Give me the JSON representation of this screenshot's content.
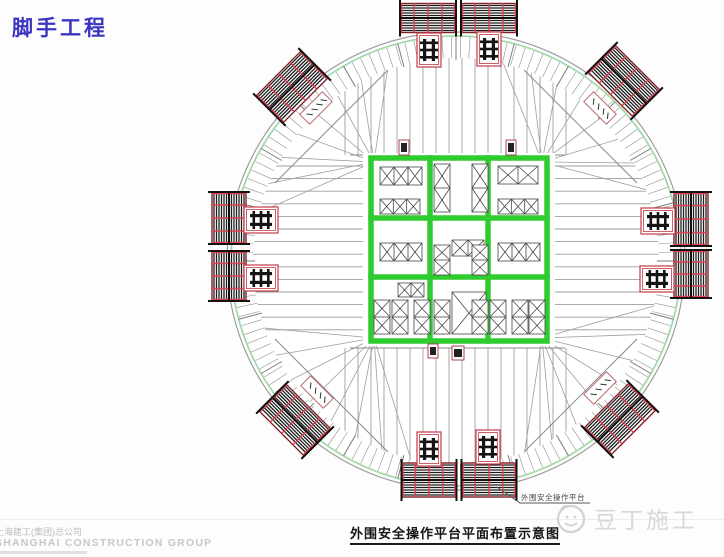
{
  "header": {
    "title": "脚手工程",
    "title_color": "#3a34c0"
  },
  "caption": {
    "text": "外围安全操作平台平面布置示意图"
  },
  "footer": {
    "watermark_cn": "上海建工(集团)总公司",
    "watermark_en": "SHANGHAI CONSTRUCTION GROUP",
    "logo_text": "豆丁施工"
  },
  "diagram": {
    "type": "construction-floor-plan",
    "center": {
      "x": 456,
      "y": 261
    },
    "radius": 229,
    "colors": {
      "core_green": "#2ecc2e",
      "rim_green": "#a5d9ab",
      "beam_gray": "#9e9e9e",
      "tick_gray": "#8f8f8f",
      "platform_outline": "#7d1f26",
      "platform_post": "#e04050",
      "symbol_red": "#c43a46",
      "stripe_black": "#1c1c1c"
    },
    "core": {
      "x": 371,
      "y": 158,
      "w": 176,
      "h": 183,
      "cols": [
        430,
        488
      ],
      "rows": [
        218,
        277
      ]
    },
    "xboxes": [
      {
        "x": 380,
        "y": 167,
        "w": 42,
        "h": 18,
        "n": 3,
        "dir": "h"
      },
      {
        "x": 434,
        "y": 164,
        "w": 16,
        "h": 48,
        "n": 2,
        "dir": "v"
      },
      {
        "x": 472,
        "y": 164,
        "w": 16,
        "h": 48,
        "n": 2,
        "dir": "v"
      },
      {
        "x": 498,
        "y": 166,
        "w": 40,
        "h": 18,
        "n": 2,
        "dir": "h"
      },
      {
        "x": 380,
        "y": 199,
        "w": 40,
        "h": 15,
        "n": 3,
        "dir": "h"
      },
      {
        "x": 498,
        "y": 199,
        "w": 40,
        "h": 15,
        "n": 3,
        "dir": "h"
      },
      {
        "x": 380,
        "y": 243,
        "w": 42,
        "h": 18,
        "n": 3,
        "dir": "h"
      },
      {
        "x": 452,
        "y": 240,
        "w": 32,
        "h": 16,
        "n": 2,
        "dir": "h"
      },
      {
        "x": 498,
        "y": 243,
        "w": 42,
        "h": 18,
        "n": 3,
        "dir": "h"
      },
      {
        "x": 434,
        "y": 245,
        "w": 16,
        "h": 30,
        "n": 2,
        "dir": "v"
      },
      {
        "x": 472,
        "y": 245,
        "w": 16,
        "h": 30,
        "n": 2,
        "dir": "v"
      },
      {
        "x": 374,
        "y": 300,
        "w": 16,
        "h": 34,
        "n": 2,
        "dir": "v"
      },
      {
        "x": 392,
        "y": 300,
        "w": 16,
        "h": 34,
        "n": 2,
        "dir": "v"
      },
      {
        "x": 414,
        "y": 300,
        "w": 16,
        "h": 34,
        "n": 2,
        "dir": "v"
      },
      {
        "x": 434,
        "y": 300,
        "w": 16,
        "h": 34,
        "n": 2,
        "dir": "v"
      },
      {
        "x": 452,
        "y": 292,
        "w": 34,
        "h": 42,
        "n": 1,
        "dir": "h"
      },
      {
        "x": 472,
        "y": 300,
        "w": 16,
        "h": 34,
        "n": 2,
        "dir": "v"
      },
      {
        "x": 490,
        "y": 300,
        "w": 16,
        "h": 34,
        "n": 2,
        "dir": "v"
      },
      {
        "x": 512,
        "y": 300,
        "w": 16,
        "h": 34,
        "n": 2,
        "dir": "v"
      },
      {
        "x": 529,
        "y": 300,
        "w": 16,
        "h": 34,
        "n": 2,
        "dir": "v"
      },
      {
        "x": 398,
        "y": 283,
        "w": 26,
        "h": 14,
        "n": 2,
        "dir": "h"
      }
    ],
    "platforms": [
      {
        "cx": 428,
        "cy": 18,
        "w": 56,
        "h": 29,
        "angle": 0
      },
      {
        "cx": 489,
        "cy": 18,
        "w": 56,
        "h": 29,
        "angle": 0
      },
      {
        "cx": 624,
        "cy": 81,
        "w": 64,
        "h": 38,
        "angle": 45
      },
      {
        "cx": 691,
        "cy": 219,
        "w": 54,
        "h": 34,
        "angle": 90
      },
      {
        "cx": 691,
        "cy": 274,
        "w": 48,
        "h": 34,
        "angle": 90
      },
      {
        "cx": 620,
        "cy": 419,
        "w": 64,
        "h": 38,
        "angle": -45
      },
      {
        "cx": 429,
        "cy": 480,
        "w": 55,
        "h": 34,
        "angle": 0
      },
      {
        "cx": 489,
        "cy": 480,
        "w": 55,
        "h": 34,
        "angle": 0
      },
      {
        "cx": 295,
        "cy": 420,
        "w": 64,
        "h": 38,
        "angle": 45
      },
      {
        "cx": 229,
        "cy": 218,
        "w": 52,
        "h": 34,
        "angle": 90
      },
      {
        "cx": 229,
        "cy": 276,
        "w": 50,
        "h": 34,
        "angle": 90
      },
      {
        "cx": 292,
        "cy": 87,
        "w": 64,
        "h": 38,
        "angle": -45
      }
    ],
    "symbols": [
      {
        "cx": 429,
        "cy": 50,
        "o": "v"
      },
      {
        "cx": 489,
        "cy": 49,
        "o": "v"
      },
      {
        "cx": 658,
        "cy": 221,
        "o": "h"
      },
      {
        "cx": 657,
        "cy": 279,
        "o": "h"
      },
      {
        "cx": 429,
        "cy": 449,
        "o": "v"
      },
      {
        "cx": 488,
        "cy": 447,
        "o": "v"
      },
      {
        "cx": 261,
        "cy": 220,
        "o": "h"
      },
      {
        "cx": 261,
        "cy": 278,
        "o": "h"
      }
    ],
    "tags": [
      {
        "cx": 316,
        "cy": 108,
        "angle": -45
      },
      {
        "cx": 600,
        "cy": 108,
        "angle": 45
      },
      {
        "cx": 600,
        "cy": 388,
        "angle": -45
      },
      {
        "cx": 317,
        "cy": 392,
        "angle": 45
      }
    ],
    "marks": [
      {
        "x": 399,
        "y": 140,
        "w": 10,
        "h": 15
      },
      {
        "x": 506,
        "y": 140,
        "w": 10,
        "h": 15
      },
      {
        "x": 428,
        "y": 344,
        "w": 10,
        "h": 14
      },
      {
        "x": 452,
        "y": 346,
        "w": 12,
        "h": 14
      }
    ],
    "fans": [
      {
        "hx": 374,
        "hy": 162,
        "a1": 190,
        "a2": 260
      },
      {
        "hx": 542,
        "hy": 162,
        "a1": 280,
        "a2": 350
      },
      {
        "hx": 542,
        "hy": 338,
        "a1": 10,
        "a2": 80
      },
      {
        "hx": 374,
        "hy": 338,
        "a1": 100,
        "a2": 170
      }
    ],
    "annotation": {
      "text": "外围安全操作平台",
      "leader": [
        [
          497,
          487
        ],
        [
          520,
          503
        ],
        [
          590,
          503
        ]
      ]
    }
  }
}
